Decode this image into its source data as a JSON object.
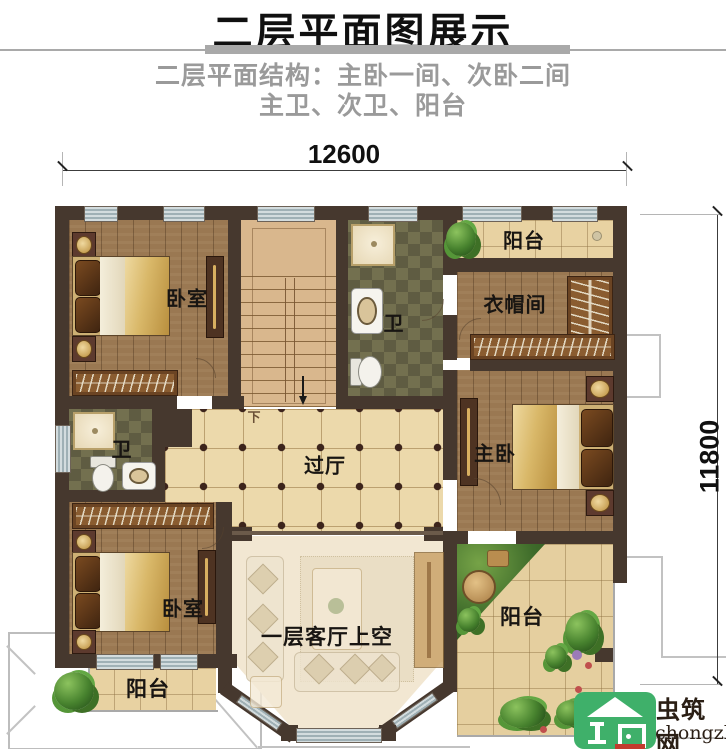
{
  "header": {
    "title": "二层平面图展示",
    "subtitle_line1": "二层平面结构：主卧一间、次卧二间",
    "subtitle_line2": "主卫、次卫、阳台"
  },
  "dimensions": {
    "top_width": "12600",
    "right_height": "11800"
  },
  "plan": {
    "labels": {
      "bedroom_top_left": "卧室",
      "bath_top": "卫",
      "balcony_top": "阳台",
      "cloakroom": "衣帽间",
      "master_bedroom": "主卧",
      "hallway": "过厅",
      "bath_left": "卫",
      "bedroom_bottom_left": "卧室",
      "living_void": "一层客厅上空",
      "balcony_bottom_left": "阳台",
      "balcony_bottom_right": "阳台",
      "stairs_down": "下"
    }
  },
  "watermark": {
    "site_name": "虫筑网",
    "site_url": "chongzhu.cn"
  },
  "colors": {
    "wall": "#46382e",
    "window": "#c8d2d5",
    "wood_floor": "#9a7852",
    "hall_tile": "#ecd9ab",
    "bath_tile": "#71704d",
    "balcony_tile": "#e8d2a2",
    "stairs": "#d9b78d",
    "logo_green": "#3fb06a",
    "title_underline": "#a9a9a9",
    "subtitle_gray": "#9a9a9a"
  }
}
